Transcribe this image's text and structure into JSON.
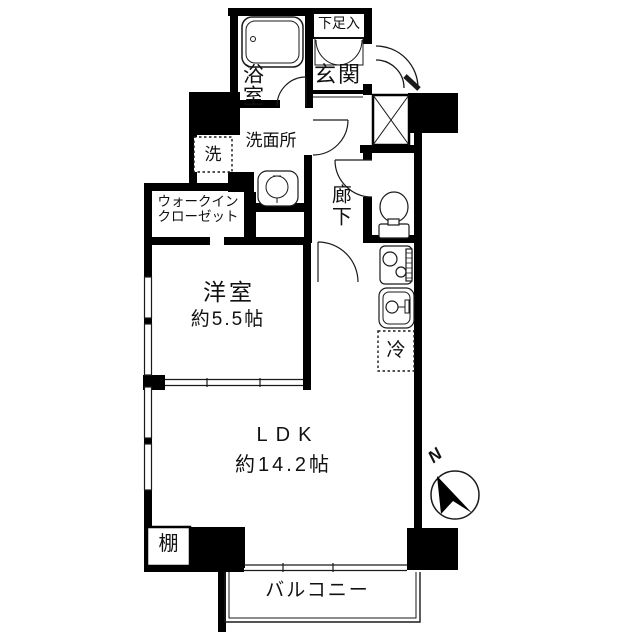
{
  "plan": {
    "bathroom": "浴室",
    "shoe_cabinet": "下足入",
    "entrance": "玄関",
    "washroom": "洗面所",
    "washer": "洗",
    "wic_line1": "ウォークイン",
    "wic_line2": "クローゼット",
    "hallway": "廊下",
    "western_room": "洋室",
    "western_room_size": "約5.5帖",
    "fridge": "冷",
    "ldk": "LDK",
    "ldk_size": "約14.2帖",
    "shelf": "棚",
    "balcony": "バルコニー",
    "compass_north": "N"
  },
  "colors": {
    "wall": "#000000",
    "line": "#1a1a1a",
    "background": "#ffffff"
  }
}
